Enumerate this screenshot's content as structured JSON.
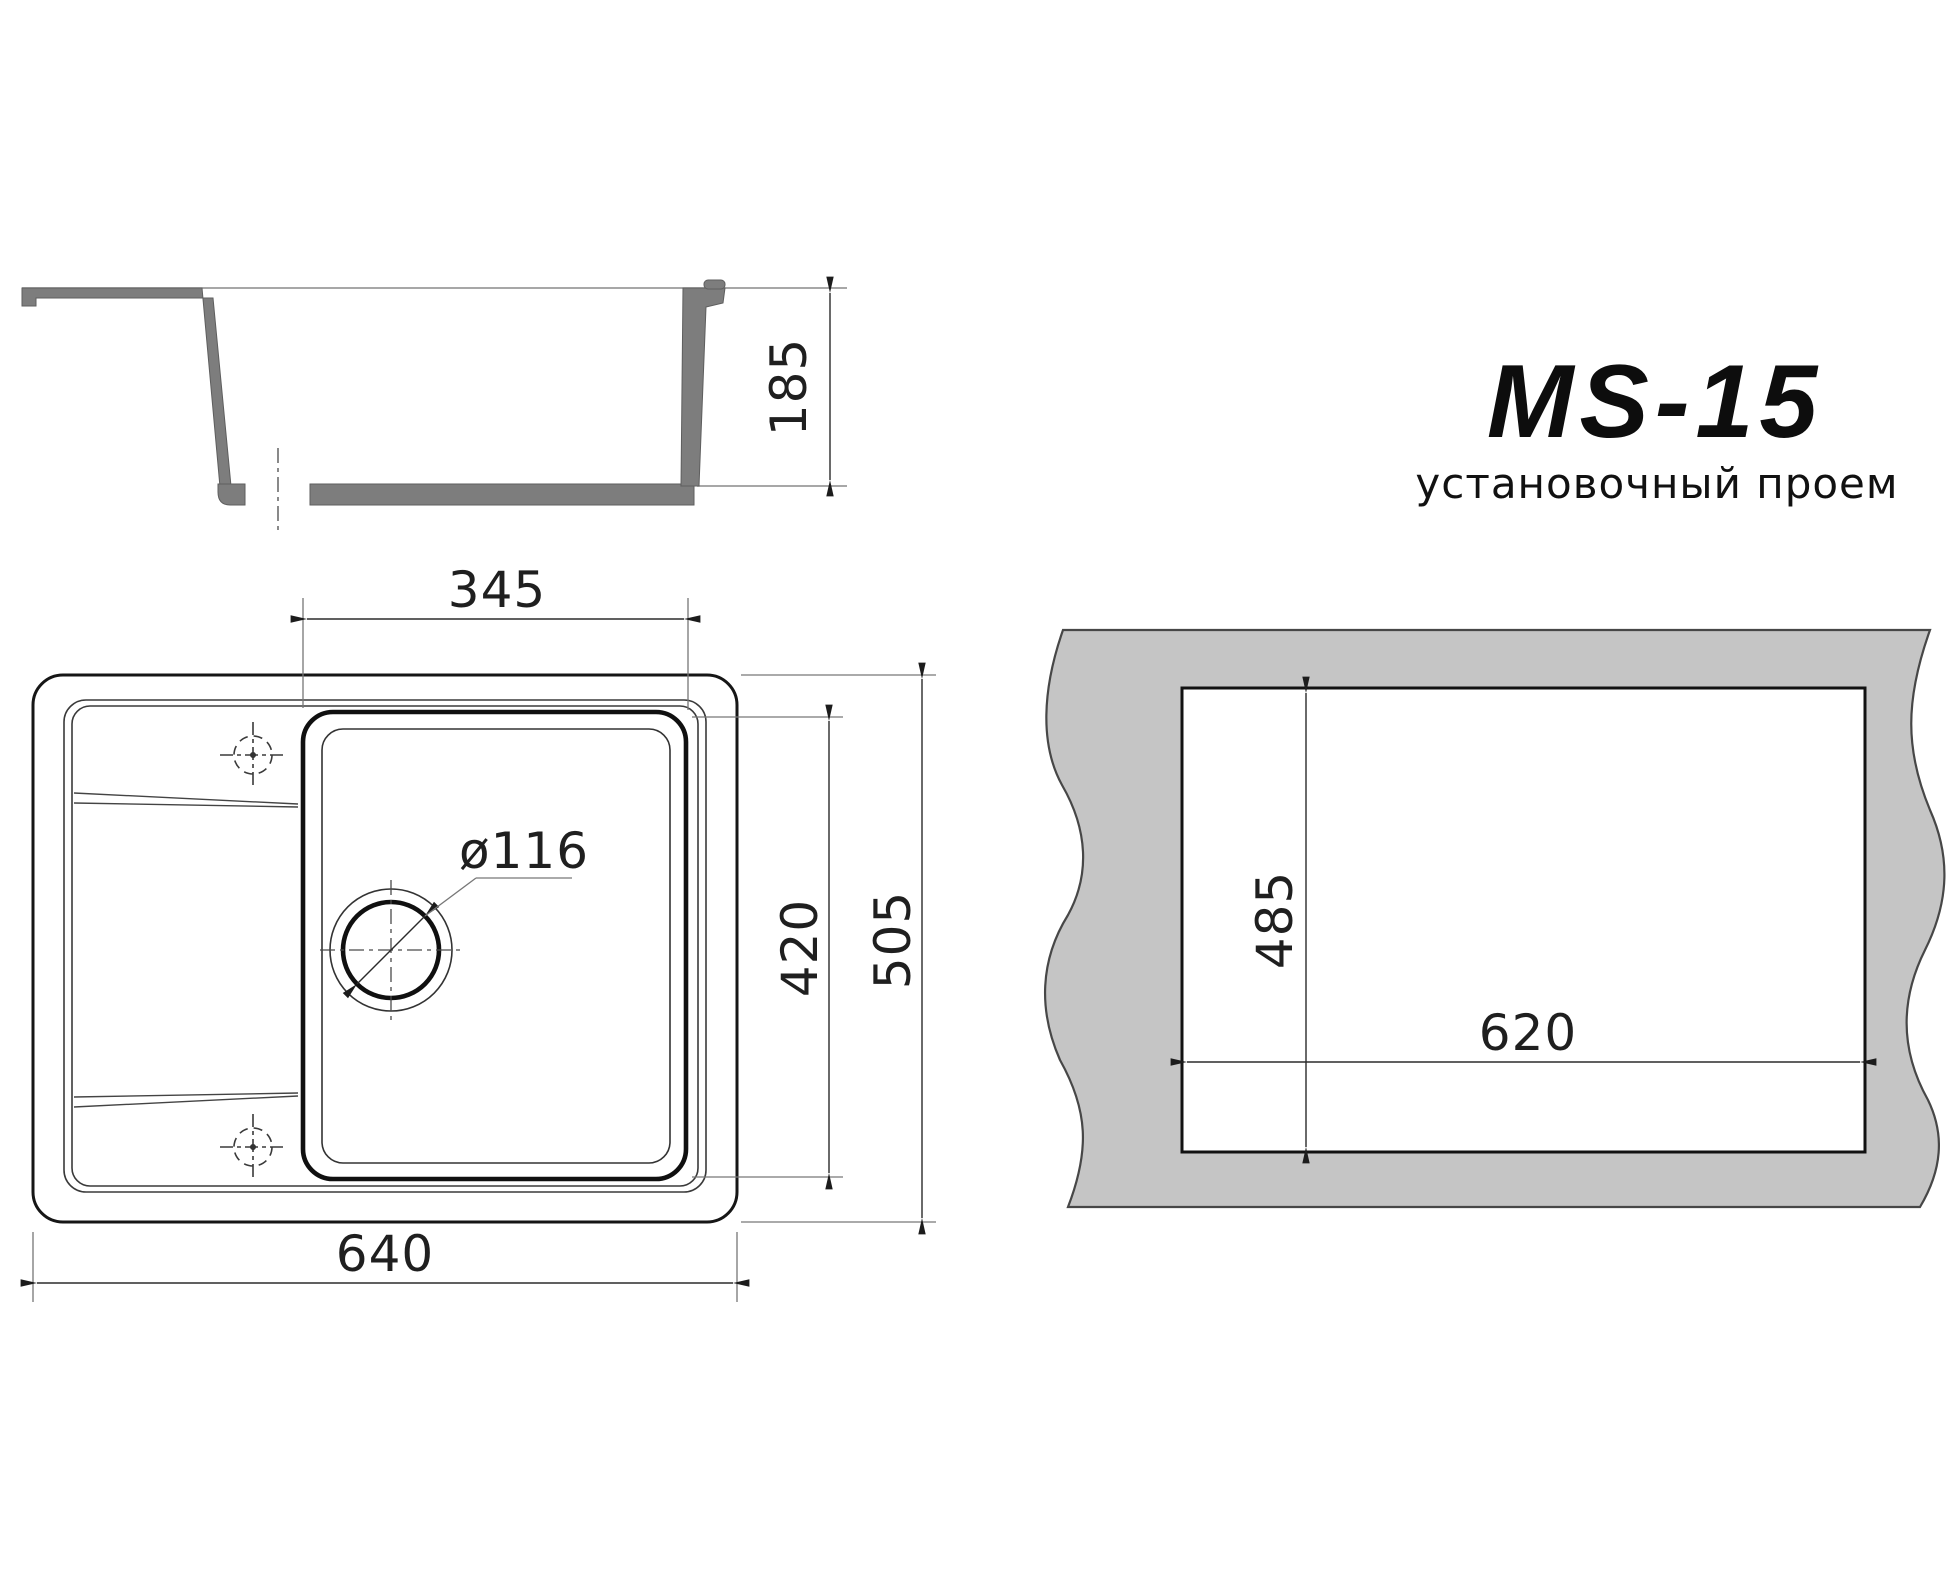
{
  "drawing": {
    "title": "MS-15",
    "subtitle": "установочный проем",
    "section_view": {
      "depth_label": "185"
    },
    "plan_view": {
      "bowl_width_label": "345",
      "bowl_depth_label": "420",
      "overall_depth_label": "505",
      "overall_width_label": "640",
      "drain_diameter_label": "ø116"
    },
    "cutout_view": {
      "cutout_depth_label": "485",
      "cutout_width_label": "620"
    },
    "colors": {
      "profile_gray": "#7d7d7d",
      "countertop_gray": "#c5c5c5",
      "line_dark": "#161616"
    }
  }
}
